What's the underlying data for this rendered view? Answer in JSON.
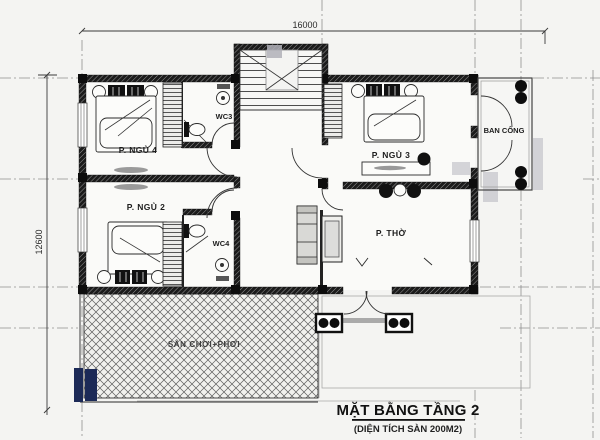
{
  "drawing": {
    "title": "MẶT BẰNG TẦNG 2",
    "subtitle": "(DIỆN TÍCH SÀN 200M2)",
    "dimensions": {
      "width_mm": "16000",
      "height_mm": "12600"
    },
    "rooms": {
      "bedroom4": "P. NGỦ 4",
      "bedroom2": "P. NGỦ 2",
      "bedroom3": "P. NGỦ 3",
      "wc3": "WC3",
      "wc4": "WC4",
      "worship_room": "P. THỜ",
      "balcony": "BAN CÔNG",
      "playground": "SÂN CHƠI+PHƠI"
    },
    "colors": {
      "paper": "#f4f4f2",
      "ink": "#1c1c1c",
      "grid_line": "#8f8f8f",
      "shadow": "#b6b6bf",
      "highlight": "#1c2a57"
    }
  }
}
